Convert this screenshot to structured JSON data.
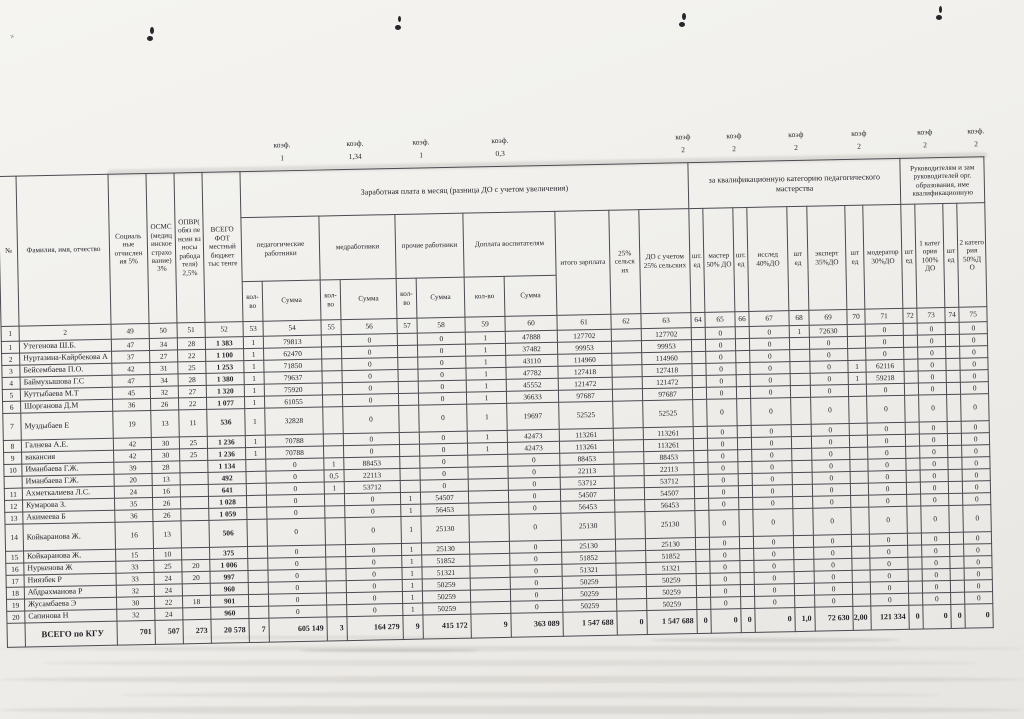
{
  "coef_row": [
    {
      "label": "коэф.",
      "value": "1"
    },
    {
      "label": "коэф.",
      "value": "1,34"
    },
    {
      "label": "коэф.",
      "value": "1"
    },
    {
      "label": "коэф.",
      "value": "0,3"
    },
    {
      "label": "коэф",
      "value": "2"
    },
    {
      "label": "коэф",
      "value": "2"
    },
    {
      "label": "коэф",
      "value": "2"
    },
    {
      "label": "коэф",
      "value": "2"
    },
    {
      "label": "коэф",
      "value": "2"
    },
    {
      "label": "коэф.",
      "value": "2"
    }
  ],
  "table": {
    "headers": {
      "num": "№",
      "fio": "Фамилия, имя, отчество",
      "social": "Социаль ные отчислен ия 5%",
      "osms": "ОСМС (медиц инское страхо вание) 3%",
      "opvr": "ОПВР( обяз пе нсии вз носы рабода теля) 2,5%",
      "vsego_fot": "ВСЕГО ФОТ местный бюджет тыс тенге",
      "salary_group": "Заработная плата в месяц (разница ДО с учетом увеличения)",
      "qual_group": "за квалификационную категорию педагогического мастерства",
      "leaders_group": "Руководителям и зам руководителей орг. образования, име квалификационную",
      "ped": "педагогические работники",
      "med": "медработники",
      "other": "прочие работники",
      "vospit": "Доплата воспитателям",
      "itogo": "итого зарплата",
      "selsk": "25% сельск их",
      "do_selsk": "ДО с учетом 25% сельских",
      "sht1": "шт. ед",
      "sht2": "шт ед",
      "master": "мастер 50% ДО",
      "issled": "исслед 40%ДО",
      "expert": "эксперт 35%ДО",
      "moderator": "модератор 30%ДО",
      "kateg1": "1 катег ория 100% ДО",
      "kateg2": "2 катего рия 50%Д О",
      "kolvo": "кол-во",
      "summa": "Сумма"
    },
    "column_numbers": [
      "1",
      "2",
      "49",
      "50",
      "51",
      "52",
      "53",
      "54",
      "55",
      "56",
      "57",
      "58",
      "59",
      "60",
      "61",
      "62",
      "63",
      "64",
      "65",
      "66",
      "67",
      "68",
      "69",
      "70",
      "71",
      "72",
      "73",
      "74",
      "75"
    ],
    "rows": [
      [
        "1",
        "Утегенова Ш.Б.",
        "47",
        "34",
        "28",
        "1 383",
        "1",
        "79813",
        "",
        "0",
        "",
        "0",
        "1",
        "47888",
        "127702",
        "",
        "127702",
        "",
        "0",
        "",
        "0",
        "1",
        "72630",
        "",
        "0",
        "",
        "0",
        "",
        "0"
      ],
      [
        "2",
        "Нуртазина-Кайрбекова А",
        "37",
        "27",
        "22",
        "1 100",
        "1",
        "62470",
        "",
        "0",
        "",
        "0",
        "1",
        "37482",
        "99953",
        "",
        "99953",
        "",
        "0",
        "",
        "0",
        "",
        "0",
        "",
        "0",
        "",
        "0",
        "",
        "0"
      ],
      [
        "3",
        "Бейсембаева П.О.",
        "42",
        "31",
        "25",
        "1 253",
        "1",
        "71850",
        "",
        "0",
        "",
        "0",
        "1",
        "43110",
        "114960",
        "",
        "114960",
        "",
        "0",
        "",
        "0",
        "",
        "0",
        "",
        "0",
        "",
        "0",
        "",
        "0"
      ],
      [
        "4",
        "Баймухышова Г.С",
        "47",
        "34",
        "28",
        "1 380",
        "1",
        "79637",
        "",
        "0",
        "",
        "0",
        "1",
        "47782",
        "127418",
        "",
        "127418",
        "",
        "0",
        "",
        "0",
        "",
        "0",
        "1",
        "62116",
        "",
        "0",
        "",
        "0"
      ],
      [
        "5",
        "Куттыбаева М.Т",
        "45",
        "32",
        "27",
        "1 320",
        "1",
        "75920",
        "",
        "0",
        "",
        "0",
        "1",
        "45552",
        "121472",
        "",
        "121472",
        "",
        "0",
        "",
        "0",
        "",
        "0",
        "1",
        "59218",
        "",
        "0",
        "",
        "0"
      ],
      [
        "6",
        "Шорганова Д.М",
        "36",
        "26",
        "22",
        "1 077",
        "1",
        "61055",
        "",
        "0",
        "",
        "0",
        "1",
        "36633",
        "97687",
        "",
        "97687",
        "",
        "0",
        "",
        "0",
        "",
        "0",
        "",
        "0",
        "",
        "0",
        "",
        "0"
      ],
      [
        "7",
        "Муздыбаев Е",
        "19",
        "13",
        "11",
        "536",
        "1",
        "32828",
        "",
        "0",
        "",
        "0",
        "1",
        "19697",
        "52525",
        "",
        "52525",
        "",
        "0",
        "",
        "0",
        "",
        "0",
        "",
        "0",
        "",
        "0",
        "",
        "0"
      ],
      [
        "8",
        "Галнева А.Е.",
        "42",
        "30",
        "25",
        "1 236",
        "1",
        "70788",
        "",
        "0",
        "",
        "0",
        "1",
        "42473",
        "113261",
        "",
        "113261",
        "",
        "0",
        "",
        "0",
        "",
        "0",
        "",
        "0",
        "",
        "0",
        "",
        "0"
      ],
      [
        "9",
        "вакансия",
        "42",
        "30",
        "25",
        "1 236",
        "1",
        "70788",
        "",
        "0",
        "",
        "0",
        "1",
        "42473",
        "113261",
        "",
        "113261",
        "",
        "0",
        "",
        "0",
        "",
        "0",
        "",
        "0",
        "",
        "0",
        "",
        "0"
      ],
      [
        "10",
        "Иманбаева Г.Ж.",
        "39",
        "28",
        "",
        "1 134",
        "",
        "0",
        "1",
        "88453",
        "",
        "0",
        "",
        "0",
        "88453",
        "",
        "88453",
        "",
        "0",
        "",
        "0",
        "",
        "0",
        "",
        "0",
        "",
        "0",
        "",
        "0"
      ],
      [
        "",
        "Иманбаева Г.Ж.",
        "20",
        "13",
        "",
        "492",
        "",
        "0",
        "0,5",
        "22113",
        "",
        "0",
        "",
        "0",
        "22113",
        "",
        "22113",
        "",
        "0",
        "",
        "0",
        "",
        "0",
        "",
        "0",
        "",
        "0",
        "",
        "0"
      ],
      [
        "11",
        "Ахметкалиева Л.С.",
        "24",
        "16",
        "",
        "641",
        "",
        "0",
        "1",
        "53712",
        "",
        "0",
        "",
        "0",
        "53712",
        "",
        "53712",
        "",
        "0",
        "",
        "0",
        "",
        "0",
        "",
        "0",
        "",
        "0",
        "",
        "0"
      ],
      [
        "12",
        "Кумарова З.",
        "35",
        "26",
        "",
        "1 028",
        "",
        "0",
        "",
        "0",
        "1",
        "54507",
        "",
        "0",
        "54507",
        "",
        "54507",
        "",
        "0",
        "",
        "0",
        "",
        "0",
        "",
        "0",
        "",
        "0",
        "",
        "0"
      ],
      [
        "13",
        "Акимеева Б",
        "36",
        "26",
        "",
        "1 059",
        "",
        "0",
        "",
        "0",
        "1",
        "56453",
        "",
        "0",
        "56453",
        "",
        "56453",
        "",
        "0",
        "",
        "0",
        "",
        "0",
        "",
        "0",
        "",
        "0",
        "",
        "0"
      ],
      [
        "14",
        "Койкаранова Ж.",
        "16",
        "13",
        "",
        "506",
        "",
        "0",
        "",
        "0",
        "1",
        "25130",
        "",
        "0",
        "25130",
        "",
        "25130",
        "",
        "0",
        "",
        "0",
        "",
        "0",
        "",
        "0",
        "",
        "0",
        "",
        "0"
      ],
      [
        "15",
        "Койкаранова Ж.",
        "15",
        "10",
        "",
        "375",
        "",
        "0",
        "",
        "0",
        "1",
        "25130",
        "",
        "0",
        "25130",
        "",
        "25130",
        "",
        "0",
        "",
        "0",
        "",
        "0",
        "",
        "0",
        "",
        "0",
        "",
        "0"
      ],
      [
        "16",
        "Нуркенова Ж",
        "33",
        "25",
        "20",
        "1 006",
        "",
        "0",
        "",
        "0",
        "1",
        "51852",
        "",
        "0",
        "51852",
        "",
        "51852",
        "",
        "0",
        "",
        "0",
        "",
        "0",
        "",
        "0",
        "",
        "0",
        "",
        "0"
      ],
      [
        "17",
        "Ниязбек Р",
        "33",
        "24",
        "20",
        "997",
        "",
        "0",
        "",
        "0",
        "1",
        "51321",
        "",
        "0",
        "51321",
        "",
        "51321",
        "",
        "0",
        "",
        "0",
        "",
        "0",
        "",
        "0",
        "",
        "0",
        "",
        "0"
      ],
      [
        "18",
        "Абдрахманова Р",
        "32",
        "24",
        "",
        "960",
        "",
        "0",
        "",
        "0",
        "1",
        "50259",
        "",
        "0",
        "50259",
        "",
        "50259",
        "",
        "0",
        "",
        "0",
        "",
        "0",
        "",
        "0",
        "",
        "0",
        "",
        "0"
      ],
      [
        "19",
        "Жусамбаева Э",
        "30",
        "22",
        "18",
        "901",
        "",
        "0",
        "",
        "0",
        "1",
        "50259",
        "",
        "0",
        "50259",
        "",
        "50259",
        "",
        "0",
        "",
        "0",
        "",
        "0",
        "",
        "0",
        "",
        "0",
        "",
        "0"
      ],
      [
        "20",
        "Сапинова Н",
        "32",
        "24",
        "",
        "960",
        "",
        "0",
        "",
        "0",
        "1",
        "50259",
        "",
        "0",
        "50259",
        "",
        "50259",
        "",
        "0",
        "",
        "0",
        "",
        "0",
        "",
        "0",
        "",
        "0",
        "",
        "0"
      ]
    ],
    "total_row": [
      "",
      "ВСЕГО по КГУ",
      "701",
      "507",
      "273",
      "20 578",
      "7",
      "605 149",
      "3",
      "164 279",
      "9",
      "415 172",
      "9",
      "363 089",
      "1 547 688",
      "0",
      "1 547 688",
      "0",
      "0",
      "0",
      "0",
      "1,0",
      "72 630",
      "2,00",
      "121 334",
      "0",
      "0",
      "0",
      "0"
    ]
  }
}
